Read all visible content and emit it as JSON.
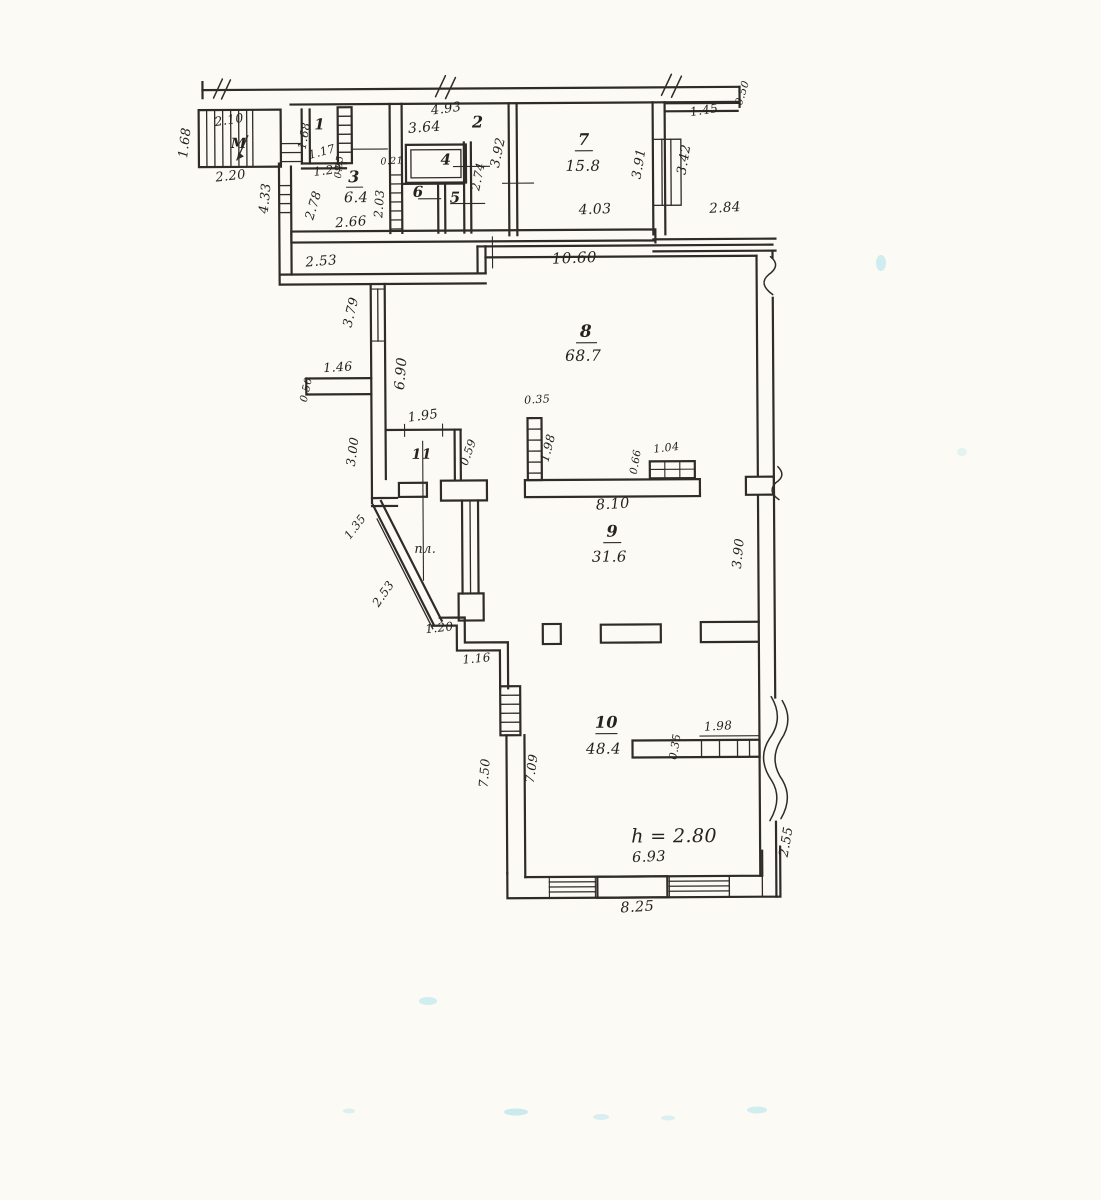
{
  "rooms": {
    "r1": {
      "number": "1"
    },
    "r2": {
      "number": "2"
    },
    "r3": {
      "number": "3",
      "area": "6.4"
    },
    "r4": {
      "number": "4"
    },
    "r5": {
      "number": "5"
    },
    "r6": {
      "number": "6"
    },
    "r7": {
      "number": "7",
      "area": "15.8"
    },
    "r8": {
      "number": "8",
      "area": "68.7"
    },
    "r9": {
      "number": "9",
      "area": "31.6"
    },
    "r10": {
      "number": "10",
      "area": "48.4"
    },
    "r11": {
      "number": "11"
    },
    "stairs": {
      "label": "М"
    },
    "landing": {
      "label": "пл."
    }
  },
  "note": {
    "ceiling_height": "h = 2.80"
  },
  "dims": {
    "stairs_depth": "1.68",
    "stairs_top": "2.10",
    "stairs_width": "2.20",
    "left_wall_upper": "4.33",
    "room1_left": "1.68",
    "room1_inner": "1.17",
    "passage_width": "1.29",
    "room3_niche": "0.85",
    "shaft_width": "0.21",
    "room2_top": "4.93",
    "room2_width": "3.64",
    "room2_height": "3.92",
    "room4_height": "2.74",
    "room3_right": "2.03",
    "room3_left": "2.78",
    "room3_bottom": "2.66",
    "room7_bottom": "4.03",
    "room7_right": "3.91",
    "wall_right_top": "3.42",
    "top_right_step": "1.45",
    "top_right_stub": "0.50",
    "right_offset": "2.84",
    "room8_top": "10.60",
    "room8_shoulder": "2.53",
    "room8_window_left": "3.79",
    "niche_width": "1.46",
    "niche_depth": "0.50",
    "room8_left": "6.90",
    "left_wall_lower": "3.00",
    "room11_top": "1.95",
    "room11_side": "0.59",
    "bar_column_width": "0.35",
    "bar_column_height": "1.98",
    "table_depth": "0.66",
    "table_width": "1.04",
    "bar_length": "8.10",
    "right_wall_mid": "3.90",
    "diag_upper": "1.35",
    "diag_lower": "2.53",
    "step_width": "1.20",
    "step_lower": "1.16",
    "room10_left_outer": "7.50",
    "room10_left_inner": "7.09",
    "shelf_depth": "0.35",
    "shelf_width": "1.98",
    "room10_bottom_inner": "6.93",
    "room10_bottom_outer": "8.25",
    "right_wall_bottom": "2.55"
  },
  "colors": {
    "ink": "#2e2b28",
    "paper": "#fbfaf5",
    "scan_artifact": "#8ed8e6"
  }
}
